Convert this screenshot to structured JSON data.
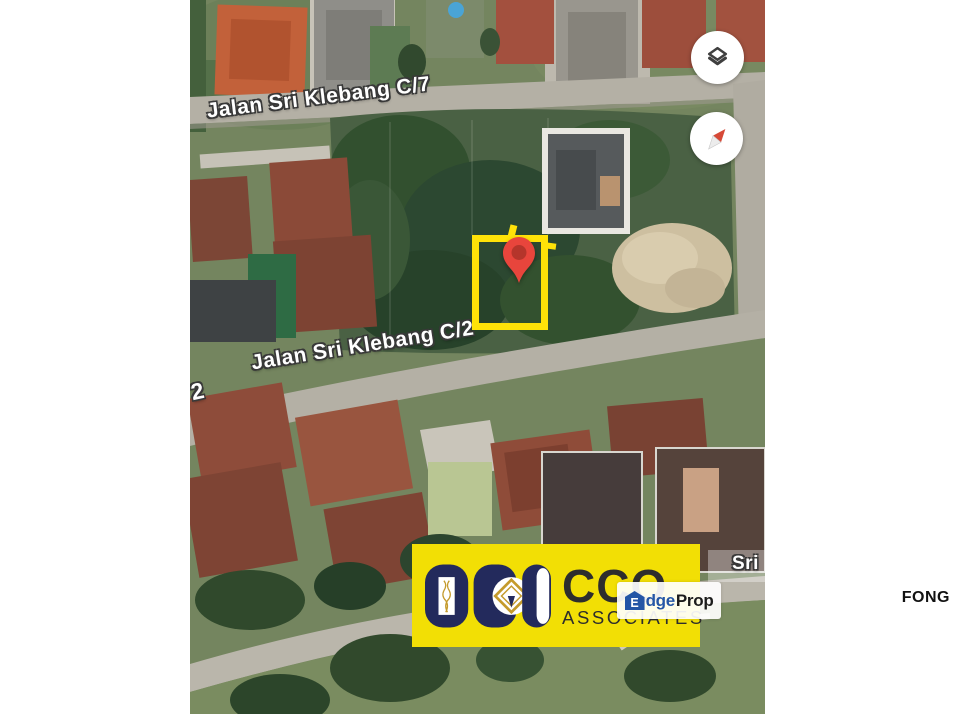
{
  "map": {
    "street_labels": [
      {
        "text": "Jalan Sri Klebang C/7"
      },
      {
        "text": "Jalan Sri Klebang C/2"
      },
      {
        "text": "2"
      },
      {
        "text": "Sri"
      }
    ],
    "controls": {
      "layers_button_icon": "layers-icon",
      "compass_button_icon": "compass-icon"
    }
  },
  "watermarks": {
    "cco": {
      "title": "CCO",
      "subtitle": "ASSOCIATES"
    },
    "edgeprop": {
      "icon_letter": "E",
      "text_mid": "dge",
      "text_end": "Prop"
    }
  },
  "side_label": {
    "text": "FONG"
  },
  "theme": {
    "highlight": "#FFE208",
    "pin": "#E8453C",
    "pin_inner": "#B5352B",
    "cco_bg": "#F2DF05",
    "cco_navy": "#232A5C",
    "cco_gold": "#C49A2C",
    "cco_text": "#2D2D2D",
    "edge_blue": "#2456A6",
    "edge_dark": "#1C1C1C"
  }
}
